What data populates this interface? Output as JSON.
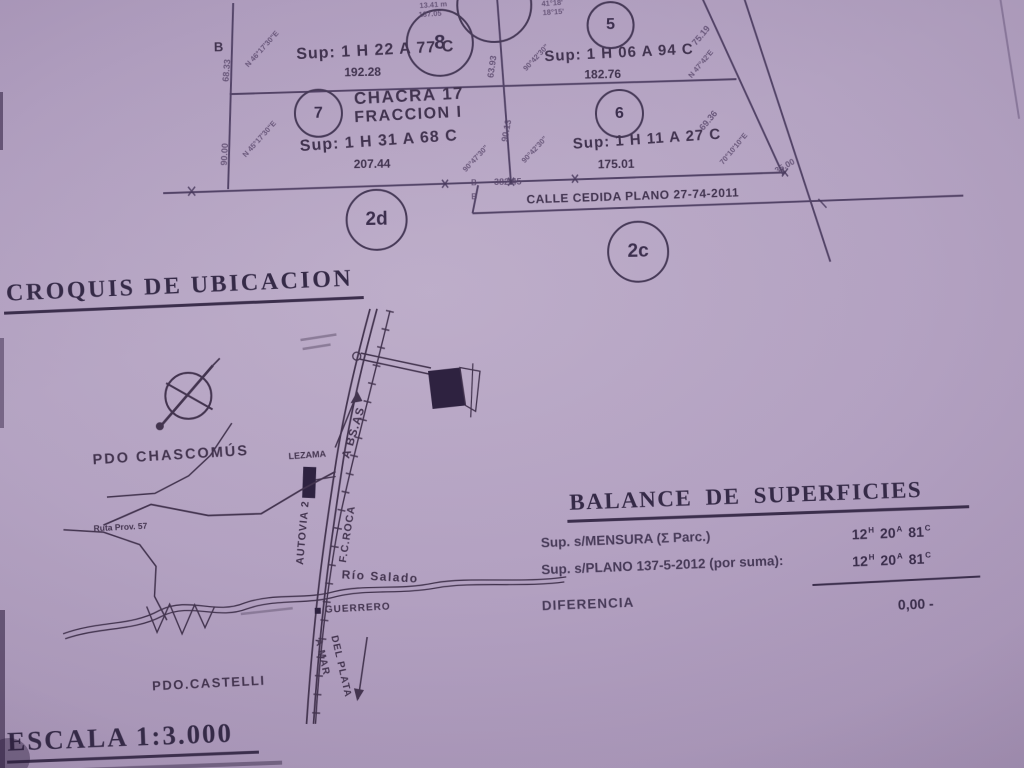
{
  "plan": {
    "corner_label": "B",
    "parcels": [
      {
        "num": "8",
        "sup": "Sup: 1 H 22 A 77 C",
        "len": "192.28"
      },
      {
        "num": "5",
        "sup": "Sup: 1 H 06 A 94 C",
        "len": "182.76"
      },
      {
        "num": "7",
        "title1": "CHACRA 17",
        "title2": "FRACCION I",
        "sup": "Sup: 1 H 31 A 68 C",
        "len": "207.44"
      },
      {
        "num": "6",
        "sup": "Sup: 1 H 11 A 27 C",
        "len": "175.01"
      }
    ],
    "zones": {
      "z1": "2d",
      "z2": "2c"
    },
    "calle": {
      "label": "CALLE CEDIDA PLANO 27-74-2011",
      "measure": "382.45",
      "tick1": "B",
      "tick2": "B"
    },
    "measurements": [
      "68.33",
      "N 46°17'30\"E",
      "90.00",
      "N 45°17'30\"E",
      "63.93",
      "90°42'30\"",
      "90.13",
      "90°47'30\"",
      "90°42'30\"",
      "75.19",
      "N 47°42'E",
      "69.36",
      "70°10'10\"E",
      "35.00",
      "13.41 m",
      "137.05",
      "41°18'",
      "18°15'"
    ]
  },
  "croquis": {
    "title": "CROQUIS DE UBICACION",
    "labels": {
      "partido_north": "PDO CHASCOMÚS",
      "town": "LEZAMA",
      "to_bsas": "A BS.AS",
      "highway": "AUTOVIA 2",
      "railway": "F.C.ROCA",
      "route": "Ruta Prov. 57",
      "river": "Río Salado",
      "station": "GUERRERO",
      "to_mdp_1": "A MAR",
      "to_mdp_2": "DEL PLATA",
      "partido_south": "PDO.CASTELLI"
    }
  },
  "balance": {
    "title": "BALANCE DE SUPERFICIES",
    "rows": [
      {
        "label": "Sup. s/MENSURA  (Σ Parc.)",
        "v1": "12",
        "u1": "H",
        "v2": "20",
        "u2": "A",
        "v3": "81",
        "u3": "C"
      },
      {
        "label": "Sup. s/PLANO 137-5-2012 (por suma):",
        "v1": "12",
        "u1": "H",
        "v2": "20",
        "u2": "A",
        "v3": "81",
        "u3": "C"
      },
      {
        "label": "DIFERENCIA",
        "value": "0,00 -"
      }
    ]
  },
  "scale_label": "ESCALA 1:3.000",
  "colors": {
    "paper": "#b3a2c1",
    "ink": "#3c2f4e"
  }
}
